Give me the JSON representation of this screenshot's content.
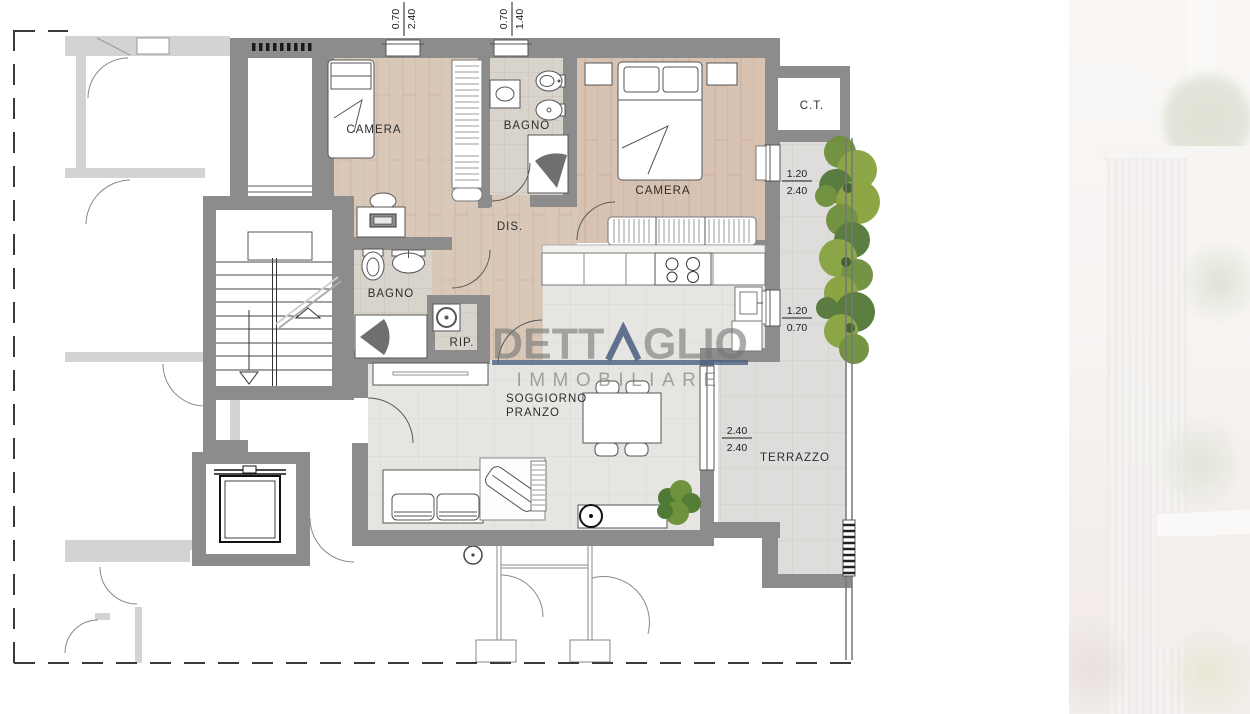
{
  "floorplan": {
    "rooms": {
      "camera1": "CAMERA",
      "bagno1": "BAGNO",
      "camera2": "CAMERA",
      "disimpegno": "DIS.",
      "bagno2": "BAGNO",
      "ripostiglio": "RIP.",
      "ct": "C.T.",
      "soggiorno_line1": "SOGGIORNO",
      "soggiorno_line2": "PRANZO",
      "terrazzo": "TERRAZZO"
    },
    "measurements": {
      "top_window_1": {
        "width": "0.70",
        "height": "2.40"
      },
      "top_window_2": {
        "width": "0.70",
        "height": "1.40"
      },
      "right_window_1": {
        "width": "1.20",
        "height": "2.40"
      },
      "right_window_2": {
        "width": "1.20",
        "height": "0.70"
      },
      "terrace_door": {
        "width": "2.40",
        "height": "2.40"
      }
    },
    "colors": {
      "wall": "#8c8c8c",
      "neighbor_wall": "#d3d3d3",
      "wood_floor": "#d9c8b8",
      "wood_floor_2": "#d8c2b1",
      "bath_floor": "#d8d3cb",
      "living_floor": "#e6e5e1",
      "terrace_floor": "#dedddb",
      "tree_green_dark": "#55793a",
      "tree_green_mid": "#6f8f3c",
      "tree_green_light": "#87a441",
      "accent_navy": "#4d6185"
    }
  },
  "watermark": {
    "brand": "DETTAGLIO",
    "brand_pre": "DETT",
    "brand_post": "GLIO",
    "subtitle": "IMMOBILIARE"
  }
}
